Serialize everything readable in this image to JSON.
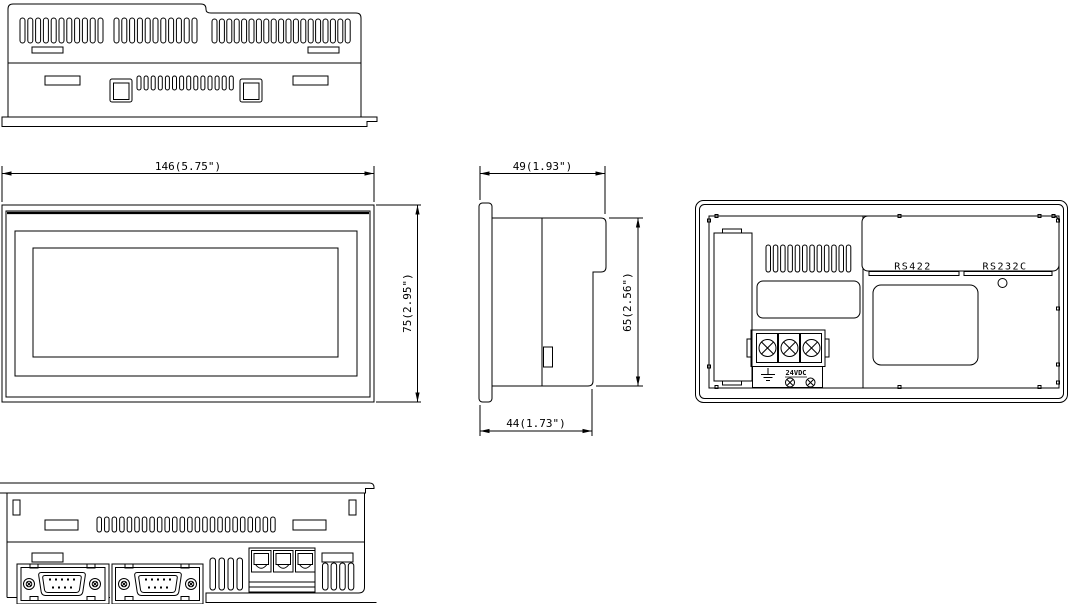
{
  "views": {
    "front": {
      "dims": {
        "width": "146(5.75\")",
        "height": "75(2.95\")"
      }
    },
    "side": {
      "dims": {
        "depth": "49(1.93\")",
        "height": "65(2.56\")",
        "body_depth": "44(1.73\")"
      }
    },
    "rear": {
      "labels": {
        "rs422": "RS422",
        "rs232c": "RS232C",
        "power": "24VDC"
      }
    }
  },
  "colors": {
    "line": "#000000",
    "background": "#ffffff"
  }
}
